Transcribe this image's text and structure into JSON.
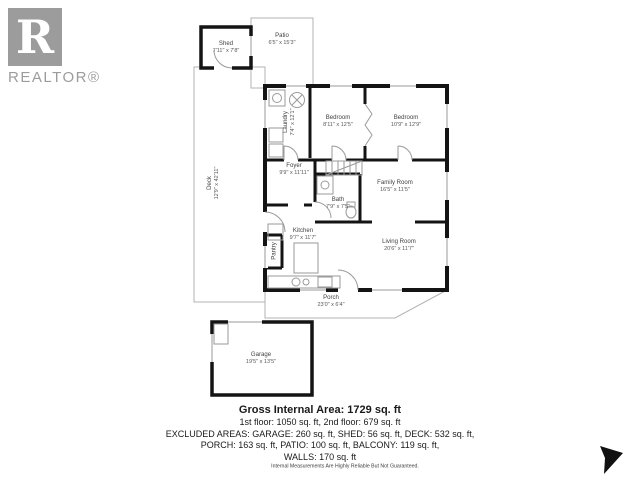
{
  "page": {
    "background": "#ffffff"
  },
  "logo": {
    "letter": "R",
    "brand": "REALTOR®",
    "color": "#9c9c9c"
  },
  "plan": {
    "wall_color": "#141414",
    "outline_color": "#b3b3b3"
  },
  "rooms": [
    {
      "id": "shed",
      "name": "Shed",
      "dims": "7'11\" x 7'8\""
    },
    {
      "id": "patio",
      "name": "Patio",
      "dims": "6'5\" x 15'3\""
    },
    {
      "id": "deck",
      "name": "Deck",
      "dims": "12'9\" x 42'11\""
    },
    {
      "id": "laundry",
      "name": "Laundry",
      "dims": "7'4\" x 12'1\""
    },
    {
      "id": "bedroom-1",
      "name": "Bedroom",
      "dims": "8'11\" x 12'5\""
    },
    {
      "id": "bedroom-2",
      "name": "Bedroom",
      "dims": "10'9\" x 12'9\""
    },
    {
      "id": "foyer",
      "name": "Foyer",
      "dims": "9'9\" x 11'11\""
    },
    {
      "id": "bath",
      "name": "Bath",
      "dims": "7'9\" x 7'5\""
    },
    {
      "id": "family-room",
      "name": "Family Room",
      "dims": "16'5\" x 11'5\""
    },
    {
      "id": "kitchen",
      "name": "Kitchen",
      "dims": "9'7\" x 11'7\""
    },
    {
      "id": "pantry",
      "name": "Pantry",
      "dims": ""
    },
    {
      "id": "living-room",
      "name": "Living Room",
      "dims": "20'6\" x 11'7\""
    },
    {
      "id": "porch",
      "name": "Porch",
      "dims": "23'0\" x 6'4\""
    },
    {
      "id": "garage",
      "name": "Garage",
      "dims": "19'5\" x 13'5\""
    }
  ],
  "summary": {
    "title": "Gross Internal Area: 1729 sq. ft",
    "floors": "1st floor: 1050 sq. ft, 2nd floor: 679 sq. ft",
    "excluded_line1": "EXCLUDED AREAS: GARAGE: 260 sq. ft, SHED: 56 sq. ft, DECK: 532 sq. ft,",
    "excluded_line2": "PORCH: 163 sq. ft, PATIO: 100 sq. ft, BALCONY: 119 sq. ft,",
    "excluded_line3": "WALLS: 170 sq. ft"
  },
  "disclaimer": "Internal Measurements Are Highly Reliable But Not Guaranteed."
}
